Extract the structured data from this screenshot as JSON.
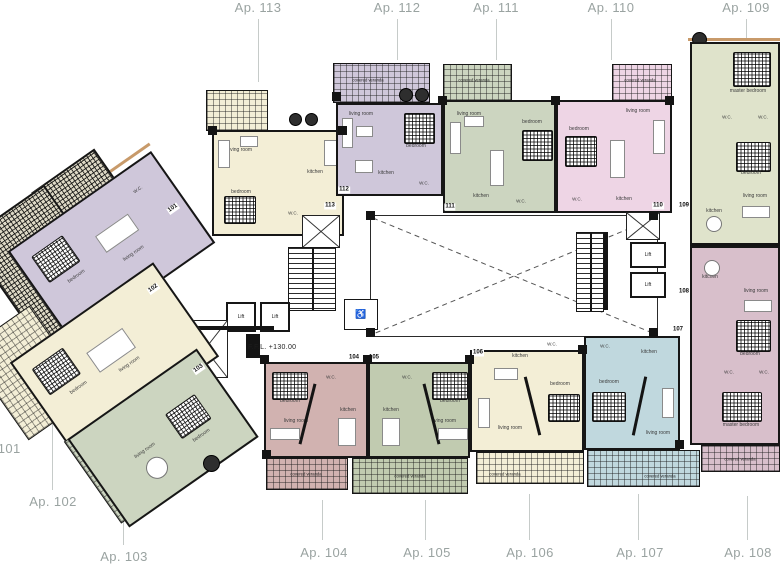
{
  "drawing": {
    "type": "architectural floor plan",
    "ffl_label": "F.F.L. +130.00",
    "veranda_label": "covered veranda",
    "lift_label": "Lift",
    "wheelchair_icon": "♿"
  },
  "palette": {
    "wall": "#151515",
    "label_gray": "#9aa3a1",
    "cream": "#f3eed6",
    "lavender": "#cfc7da",
    "sage": "#ccd5c0",
    "pink": "#eed5e5",
    "khaki": "#dfe3cb",
    "mauve": "#d8bfcb",
    "rose": "#d1b2b0",
    "sage2": "#c1cbb0",
    "cyan": "#c0d8de",
    "dark_veranda_base": "#ded9c6",
    "accent_orange": "#c89a6a"
  },
  "perimeter_labels": [
    {
      "text": "Ap. 101"
    },
    {
      "text": "Ap. 102"
    },
    {
      "text": "Ap. 103"
    },
    {
      "text": "Ap. 104"
    },
    {
      "text": "Ap. 105"
    },
    {
      "text": "Ap. 106"
    },
    {
      "text": "Ap. 107"
    },
    {
      "text": "Ap. 108"
    },
    {
      "text": "Ap. 109"
    },
    {
      "text": "Ap. 110"
    },
    {
      "text": "Ap. 111"
    },
    {
      "text": "Ap. 112"
    },
    {
      "text": "Ap. 113"
    }
  ],
  "apartments": {
    "ap101": {
      "tag": "101",
      "color": "#cfc7da",
      "rooms": {
        "bedroom": "bedroom",
        "living": "living room",
        "wc": "W.C."
      }
    },
    "ap102": {
      "tag": "102",
      "color": "#f3eed6",
      "rooms": {
        "bedroom": "bedroom",
        "living": "living room"
      }
    },
    "ap103": {
      "tag": "103",
      "color": "#ccd5c0",
      "rooms": {
        "bedroom": "bedroom",
        "living": "living room"
      }
    },
    "ap104": {
      "tag": "104",
      "color": "#d1b2b0",
      "rooms": {
        "bedroom": "bedroom",
        "wc": "W.C.",
        "kitchen": "kitchen",
        "living": "living room"
      }
    },
    "ap105": {
      "tag": "105",
      "color": "#c1cbb0",
      "rooms": {
        "bedroom": "bedroom",
        "wc": "W.C.",
        "kitchen": "kitchen",
        "living": "living room"
      }
    },
    "ap106": {
      "tag": "106",
      "color": "#f3eed6",
      "rooms": {
        "bedroom": "bedroom",
        "wc": "W.C.",
        "kitchen": "kitchen",
        "living": "living room"
      }
    },
    "ap107": {
      "tag": "107",
      "color": "#c0d8de",
      "rooms": {
        "bedroom": "bedroom",
        "wc": "W.C.",
        "kitchen": "kitchen",
        "living": "living room"
      }
    },
    "ap108": {
      "tag": "108",
      "color": "#d8bfcb",
      "rooms": {
        "kitchen": "kitchen",
        "living": "living room",
        "bedroom": "bedroom",
        "wc": "W.C.",
        "wc2": "W.C.",
        "master": "master bedroom"
      }
    },
    "ap109": {
      "tag": "109",
      "color": "#dfe3cb",
      "rooms": {
        "master": "master bedroom",
        "wc": "W.C.",
        "wc2": "W.C.",
        "bedroom": "bedroom",
        "living": "living room",
        "kitchen": "kitchen"
      }
    },
    "ap110": {
      "tag": "110",
      "color": "#eed5e5",
      "rooms": {
        "bedroom": "bedroom",
        "living": "living room",
        "kitchen": "kitchen",
        "wc": "W.C."
      }
    },
    "ap111": {
      "tag": "111",
      "color": "#ccd5c0",
      "rooms": {
        "living": "living room",
        "bedroom": "bedroom",
        "kitchen": "kitchen",
        "wc": "W.C."
      }
    },
    "ap112": {
      "tag": "112",
      "color": "#cfc7da",
      "rooms": {
        "living": "living room",
        "bedroom": "bedroom",
        "kitchen": "kitchen",
        "wc": "W.C."
      }
    },
    "ap113": {
      "tag": "113",
      "color": "#f3eed6",
      "rooms": {
        "living": "living room",
        "kitchen": "kitchen",
        "bedroom": "bedroom",
        "wc": "W.C."
      }
    }
  }
}
